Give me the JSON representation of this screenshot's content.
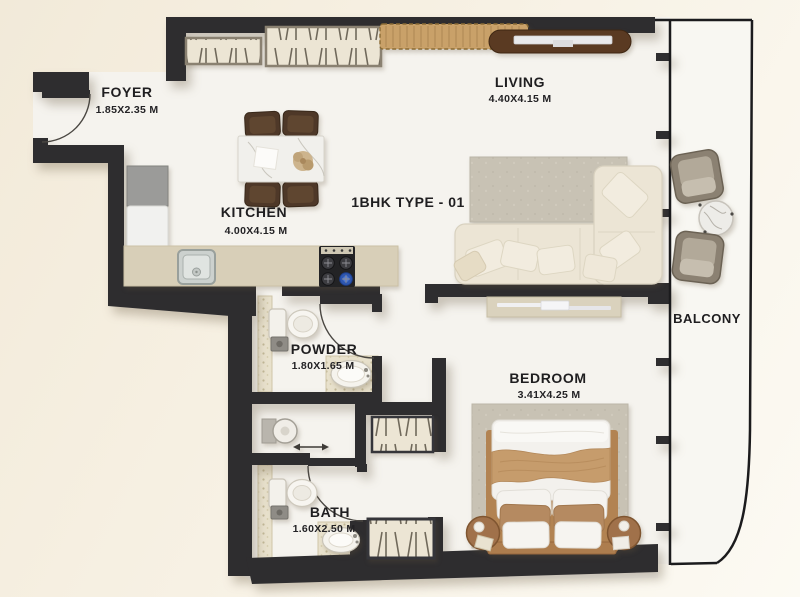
{
  "floorplan": {
    "title": "1BHK TYPE - 01",
    "rooms": {
      "foyer": {
        "name": "FOYER",
        "dims": "1.85X2.35 M"
      },
      "kitchen": {
        "name": "KITCHEN",
        "dims": "4.00X4.15 M"
      },
      "living": {
        "name": "LIVING",
        "dims": "4.40X4.15 M"
      },
      "powder": {
        "name": "POWDER",
        "dims": "1.80X1.65 M"
      },
      "bath": {
        "name": "BATH",
        "dims": "1.60X2.50 M"
      },
      "bedroom": {
        "name": "BEDROOM",
        "dims": "3.41X4.25 M"
      },
      "balcony": {
        "name": "BALCONY",
        "dims": ""
      }
    },
    "colors": {
      "wall": "#2e2d2f",
      "floor": "#f5f3ee",
      "counter": "#d8cfb8",
      "cabinet_tan": "#c9a169",
      "console_wood": "#5a3a22",
      "sofa_cream": "#ece5d5",
      "rug_gray": "#c8c2b4",
      "throw_tan": "#c69c6c",
      "stove_burner_blue": "#2e57b0"
    }
  }
}
